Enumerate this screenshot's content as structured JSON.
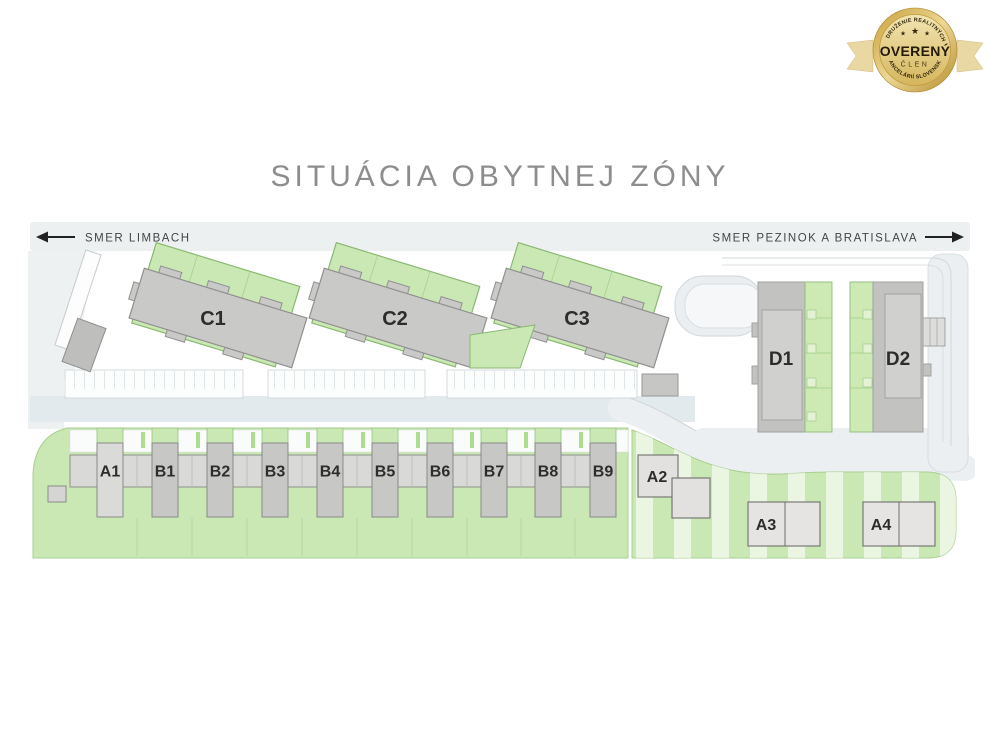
{
  "badge": {
    "arc_top": "ZDRUŽENIE REALITNÝCH",
    "arc_bottom": "KANCELÁRIÍ SLOVENSKA",
    "star_icon": "★",
    "title": "OVERENÝ",
    "subtitle": "ČLEN"
  },
  "page_title": "SITUÁCIA OBYTNEJ ZÓNY",
  "map": {
    "direction_left": "SMER LIMBACH",
    "direction_right": "SMER PEZINOK A BRATISLAVA",
    "c_buildings": [
      "C1",
      "C2",
      "C3"
    ],
    "d_buildings": [
      "D1",
      "D2"
    ],
    "row_houses": [
      "A1",
      "B1",
      "B2",
      "B3",
      "B4",
      "B5",
      "B6",
      "B7",
      "B8",
      "B9"
    ],
    "a_buildings": [
      "A2",
      "A3",
      "A4"
    ]
  },
  "colors": {
    "parcel_green": "#c9e8b3",
    "parcel_green_border": "#8ab873",
    "building_gray": "#c7c7c5",
    "building_light_gray": "#e2e1df",
    "road_gray": "#edf0f1",
    "road_blue_gray": "#e3eaee",
    "label_dark": "#2d2d2d",
    "badge_gold": "#d8b969"
  }
}
